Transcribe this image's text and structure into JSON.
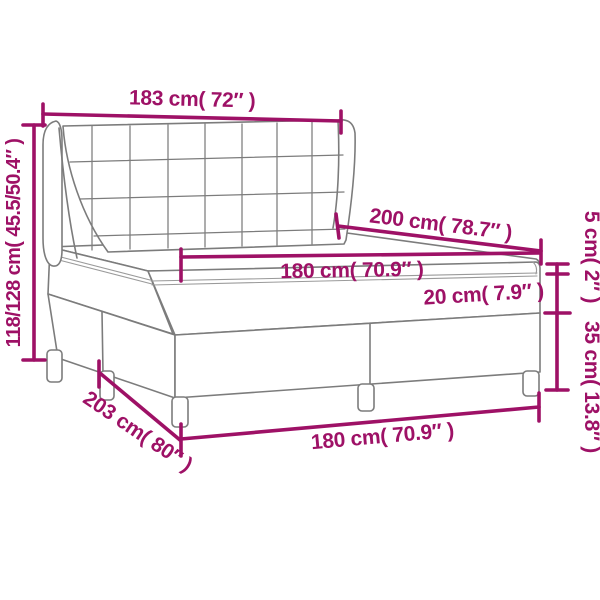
{
  "diagram": {
    "title": "box-spring-bed-dimension-diagram",
    "colors": {
      "dimension_accent": "#9E1166",
      "drawing_line": "#7c7c7c",
      "background": "#ffffff"
    },
    "labels": {
      "headboard_width": "183 cm( 72″ )",
      "total_height": "118/128 cm( 45.5/50.4″ )",
      "bed_length": "200 cm( 78.7″ )",
      "mattress_width": "180 cm( 70.9″ )",
      "mattress_height": "20 cm( 7.9″ )",
      "topper_height": "5 cm( 2″ )",
      "base_height": "35 cm( 13.8″ )",
      "base_length": "203 cm( 80″ )",
      "base_width": "180 cm( 70.9″ )"
    }
  }
}
